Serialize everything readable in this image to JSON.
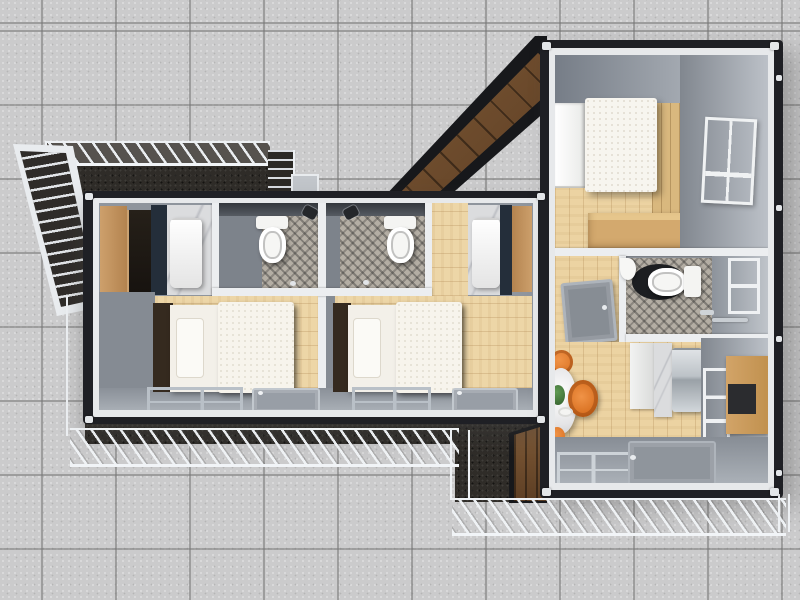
{
  "scene": {
    "type": "top-down-3d-floor-plan-render",
    "canvas": {
      "width": 800,
      "height": 600
    },
    "palette": {
      "ground_tile": "#cbcbcc",
      "tile_grout": "#a6a6a8",
      "container_frame": "#1f2025",
      "inner_frame": "#e7e9eb",
      "wall_gray": "#9aa0a8",
      "wood_floor": "#edd6a7",
      "wood_accent_wall": "#d9b87e",
      "wood_siding": "#6f4e2f",
      "deck_dark": "#2f2c28",
      "railing_light": "#eef1f4",
      "mosaic_tile": "#b4aea4",
      "fixture_white": "#f5f5f3",
      "wardrobe_tan": "#c49a68",
      "counter_navy": "#242e3a",
      "marble": "#dbdcde",
      "stainless_steel": "#c3c8cc",
      "chair_orange": "#e07a2b",
      "plant_green": "#47793f",
      "bed_linen": "#f5f2ea",
      "headboard_brown": "#352a1f"
    },
    "buildings": [
      {
        "id": "container-left",
        "orientation": "horizontal",
        "units": [
          {
            "name": "guest-unit-1",
            "zones": [
              "entry-kitchenette",
              "bathroom",
              "sleeping-area"
            ],
            "furniture": [
              "wardrobe",
              "tall-cabinet",
              "mini-fridge",
              "toilet",
              "shower-head",
              "floor-drain",
              "bed",
              "window",
              "entry-door"
            ]
          },
          {
            "name": "guest-unit-2",
            "zones": [
              "entry-kitchenette",
              "bathroom",
              "sleeping-area"
            ],
            "furniture": [
              "wardrobe",
              "mini-fridge",
              "toilet",
              "shower-head",
              "floor-drain",
              "bed",
              "window",
              "entry-door"
            ]
          }
        ]
      },
      {
        "id": "container-right",
        "orientation": "vertical",
        "zones": [
          {
            "name": "bedroom",
            "furniture": [
              "double-bed",
              "white-wardrobe",
              "wood-accent-wall",
              "desk",
              "sash-window"
            ]
          },
          {
            "name": "bathroom",
            "furniture": [
              "toilet",
              "dark-floor-mat",
              "corner-sink",
              "vanity",
              "faucet",
              "towel-bar",
              "window"
            ],
            "adjacent": "entry-hallway-with-side-door"
          },
          {
            "name": "kitchen-dining",
            "furniture": [
              "round-marble-dining-table",
              "orange-chair",
              "orange-lounge-chair",
              "orange-chair",
              "potted-plant",
              "tableware",
              "cabinet",
              "marble-counter",
              "fridge",
              "wall-cabinets",
              "window",
              "rear-door",
              "rear-window"
            ]
          }
        ]
      }
    ],
    "outdoor": {
      "features": [
        "paved-tile-ground",
        "upper-entry-deck",
        "deck-railing",
        "access-stairs",
        "corner-stair-railing",
        "lower-walkway-railing-left",
        "walkway-step-connector",
        "lower-walkway-railing-bottom",
        "dark-composite-decking",
        "wood-siding-slant-upper",
        "wood-siding-slant-lower"
      ]
    }
  }
}
